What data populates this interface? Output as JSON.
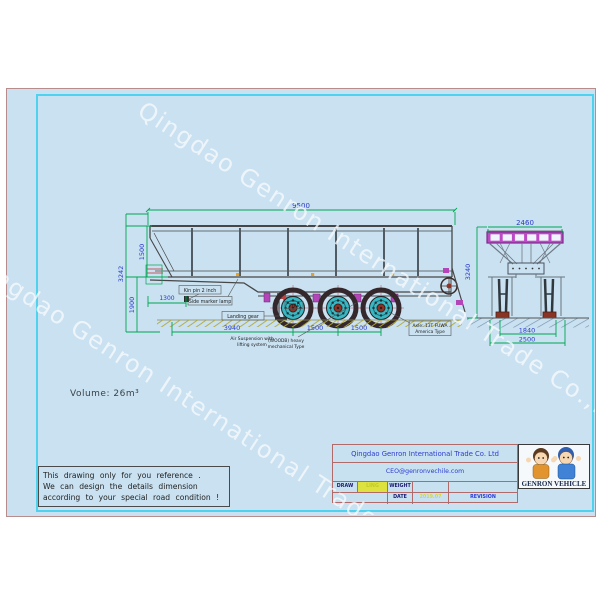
{
  "page": {
    "volume_text": "Volume:  26m³"
  },
  "watermark": {
    "text": "Qingdao Genron International Trade Co.,Ltd"
  },
  "note_box": {
    "line1": "This drawing only for you reference .",
    "line2": "We can design the details dimension",
    "line3": "according to your special road condition !"
  },
  "side_view": {
    "dim_length": "9500",
    "dim_overall_height": "3242",
    "dim_body_height": "1500",
    "dim_frame_height": "1900",
    "dim_kingpin_setback": "1300",
    "dim_kingpin_to_axle": "3940",
    "dim_axle_gap1": "1500",
    "dim_axle_gap2": "1500",
    "label_kingpin": "Kin pin 2 inch",
    "label_side_marker": "Side marker lamp",
    "label_landing_gear": "Landing gear",
    "label_tyre": "TYRE",
    "label_axle_1": "Axle: 13T FUWA",
    "label_axle_2": "America Type",
    "label_susp_a1": "Air Suspension with",
    "label_susp_a2": "lifting system",
    "label_susp_b1": "(WOODB) heavy",
    "label_susp_b2": "mechanical Type"
  },
  "rear_view": {
    "dim_top_width": "2460",
    "dim_overall_height": "3240",
    "dim_inner": "1840",
    "dim_outer": "2500"
  },
  "title_block": {
    "company": "Qingdao Genron International Trade Co. Ltd",
    "email": "CEO@genronvechile.com",
    "draw_label": "DRAW",
    "draw_value": "LING",
    "weight_label": "WEIGHT",
    "date_label": "DATE",
    "date_value": "2019.07",
    "revision_label": "REVISION",
    "logo_text": "GENRON VEHICLE"
  }
}
